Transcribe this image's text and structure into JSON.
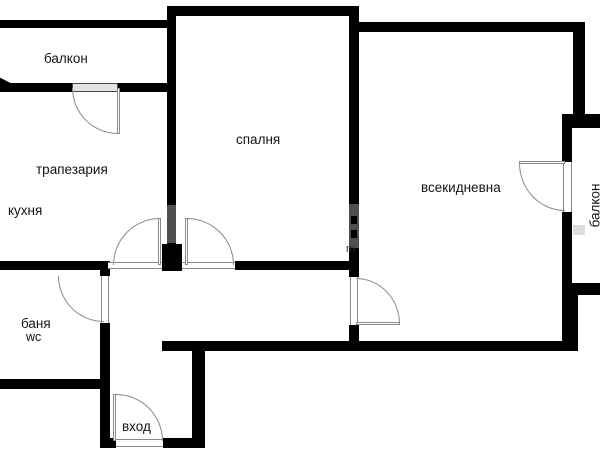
{
  "plan_title": "apartment floor plan",
  "colors": {
    "background": "#ffffff",
    "wall": "#000000",
    "door_line": "#8a8a8a",
    "door_fill": "#e3e3e3",
    "label": "#141414",
    "watermark_gray": "#4f4f4f",
    "watermark_light": "#dcdcdc"
  },
  "rooms": {
    "balcony_top": {
      "label": "балкон"
    },
    "dining": {
      "label": "трапезария"
    },
    "kitchen": {
      "label": "кухня"
    },
    "bedroom": {
      "label": "спалня"
    },
    "living": {
      "label": "всекидневна"
    },
    "balcony_right": {
      "label": "балкон"
    },
    "bathroom": {
      "label": "баня",
      "sublabel": "wc"
    },
    "entry": {
      "label": "вход"
    }
  },
  "watermark": {
    "artifact": "m"
  }
}
